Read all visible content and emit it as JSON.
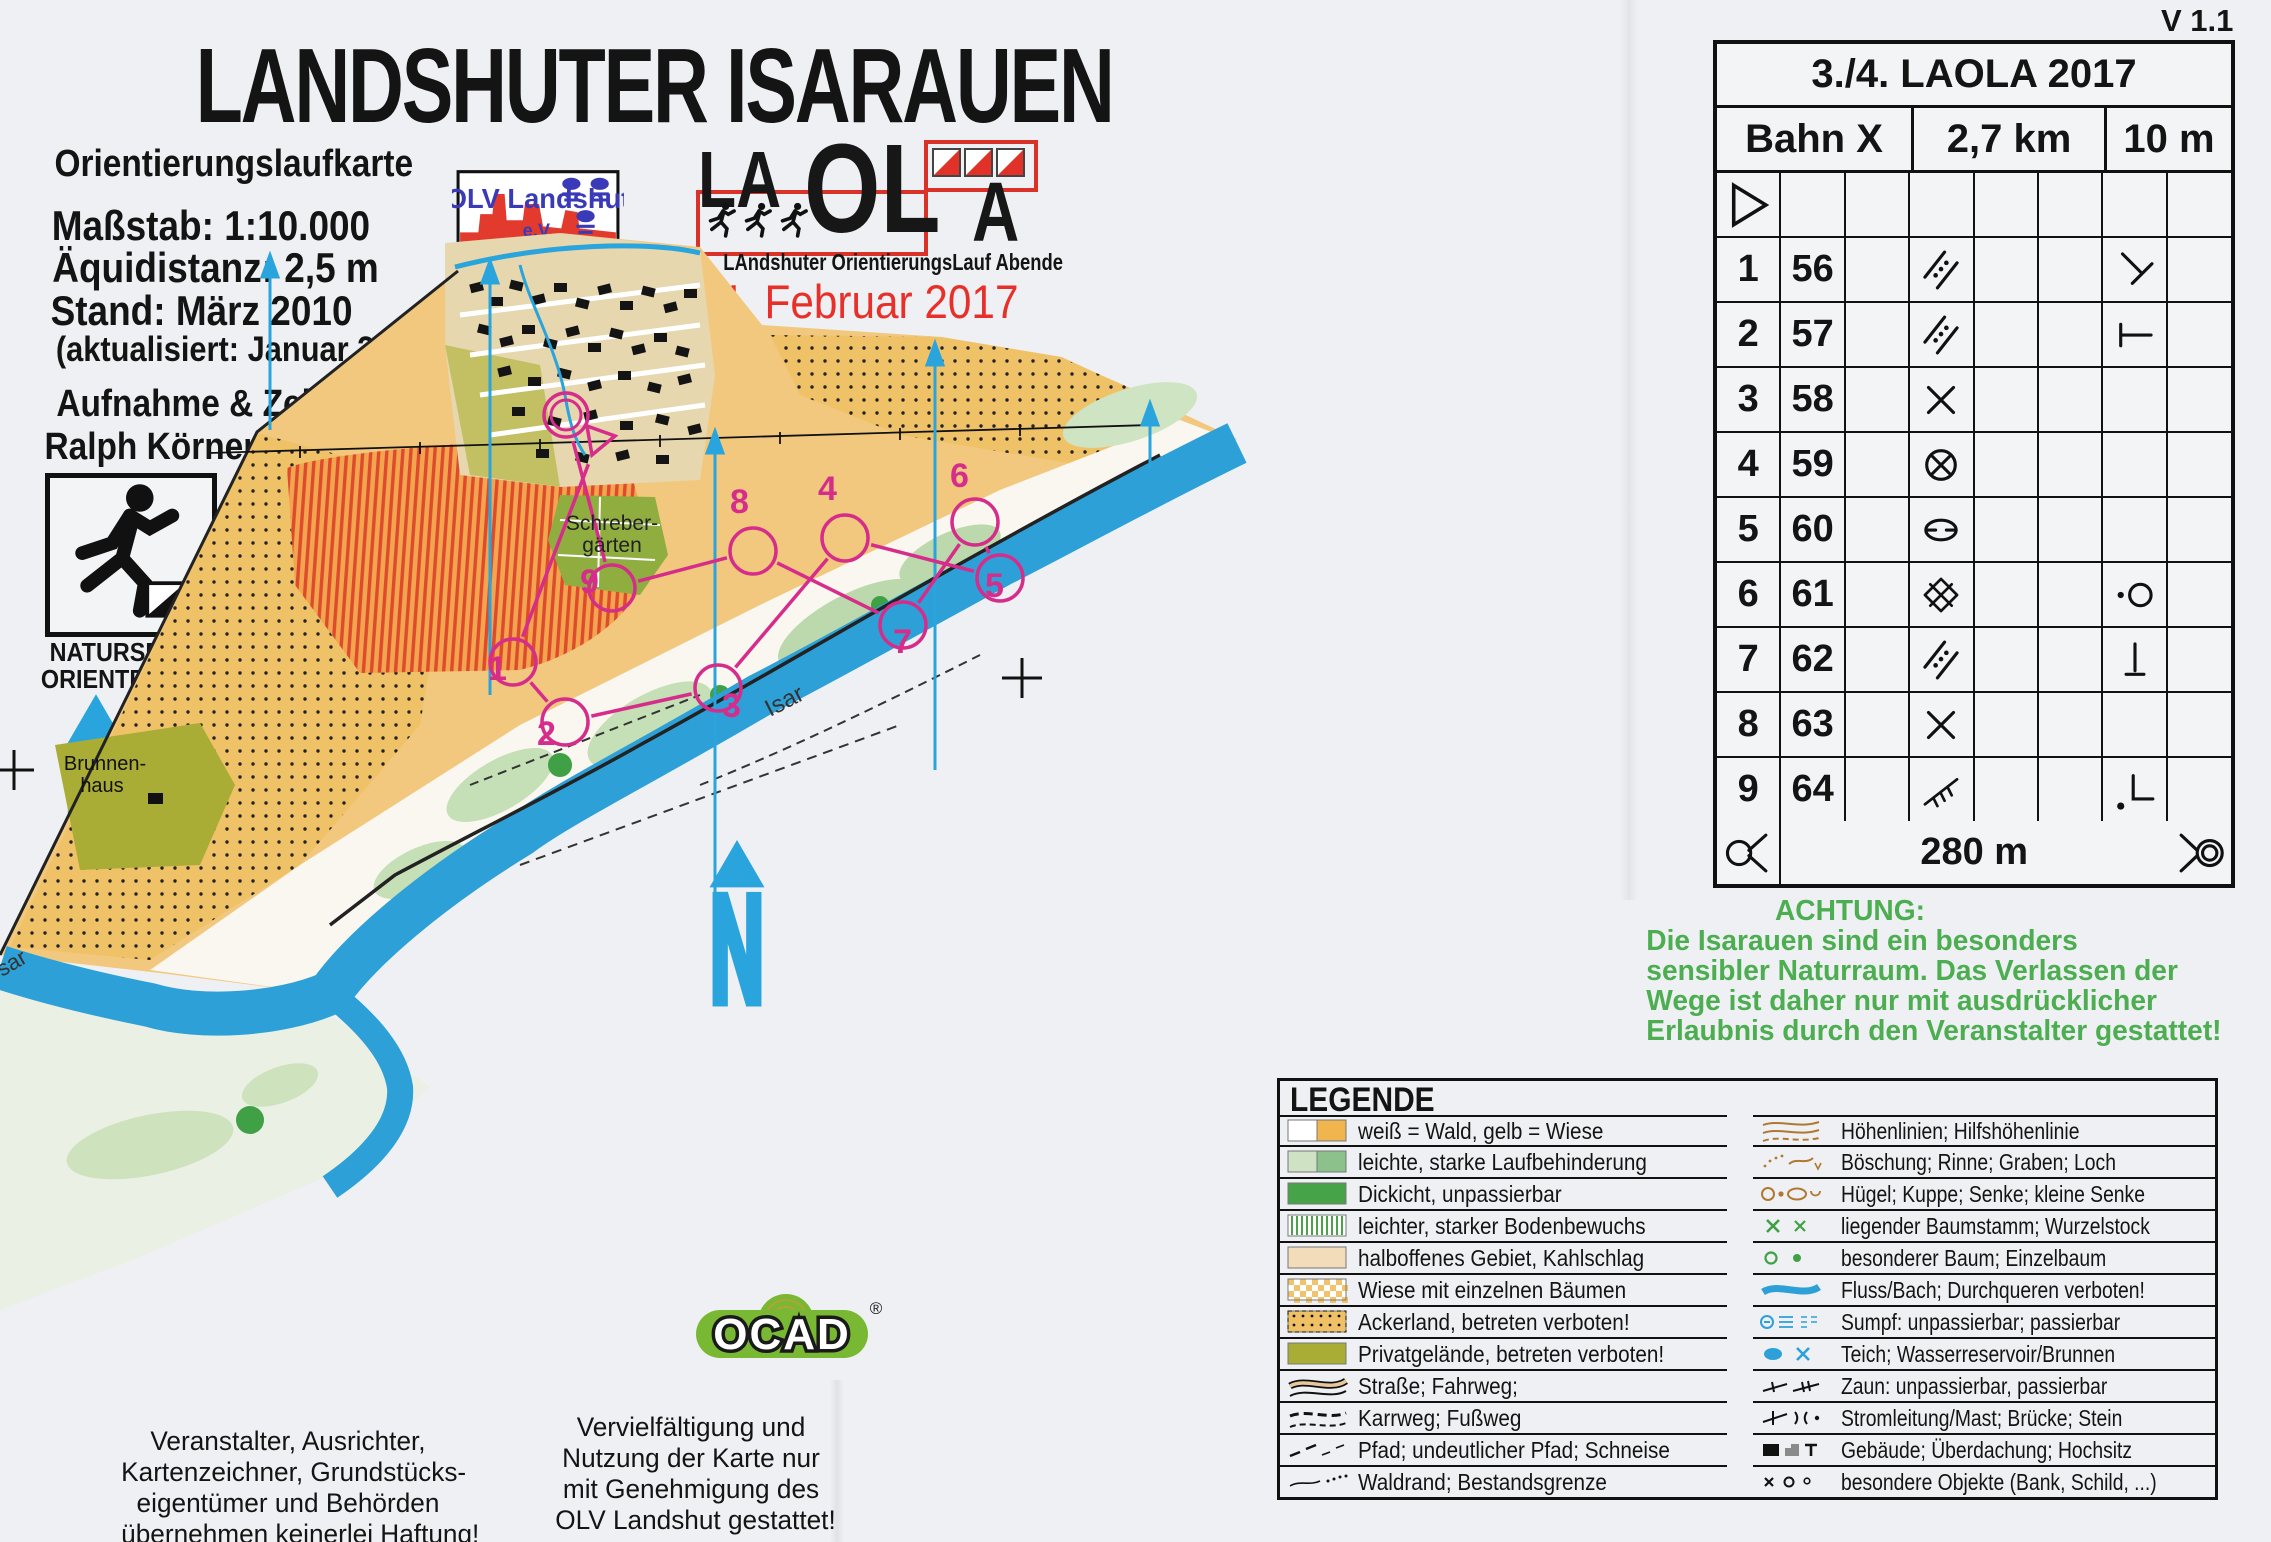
{
  "version_label": "V 1.1",
  "header": {
    "title": "LANDSHUTER ISARAUEN",
    "subtitle": "Orientierungslaufkarte",
    "scale": "Maßstab: 1:10.000",
    "equidistance": "Äquidistanz: 2,5 m",
    "edition": "Stand: März 2010",
    "updated": "(aktualisiert: Januar 2017)",
    "credit_label": "Aufnahme & Zeichnung:",
    "credit_name": "Ralph Körner"
  },
  "natursport": {
    "line1": "NATURSPORT",
    "line2": "ORIENTEERING"
  },
  "club": {
    "shield_name": "OLV Landshut",
    "shield_ev": "e.V.",
    "org_line1": "Orientierungslaufverein",
    "org_line2": "Landshut e.V.",
    "website": "www.ol-landshut.de"
  },
  "laola": {
    "part_la": "LA",
    "part_ol": "OL",
    "part_a": "A",
    "caption": "LAndshuter OrientierungsLauf Abende",
    "event_date": "4. Februar 2017"
  },
  "control_card": {
    "title": "3./4. LAOLA 2017",
    "course": "Bahn X",
    "length": "2,7 km",
    "climb": "10 m",
    "rows": [
      {
        "cells": [
          "icon:start-triangle",
          "",
          "",
          "",
          "",
          "",
          "",
          ""
        ]
      },
      {
        "cells": [
          "1",
          "56",
          "",
          "icon:veg-boundary",
          "",
          "",
          "icon:bend",
          ""
        ]
      },
      {
        "cells": [
          "2",
          "57",
          "",
          "icon:veg-boundary",
          "",
          "",
          "icon:junction",
          ""
        ]
      },
      {
        "cells": [
          "3",
          "58",
          "",
          "icon:cross",
          "",
          "",
          "",
          ""
        ]
      },
      {
        "cells": [
          "4",
          "59",
          "",
          "icon:circle-cross",
          "",
          "",
          "",
          ""
        ]
      },
      {
        "cells": [
          "5",
          "60",
          "",
          "icon:depression",
          "",
          "",
          "",
          ""
        ]
      },
      {
        "cells": [
          "6",
          "61",
          "",
          "icon:thicket",
          "",
          "",
          "icon:dot-circle",
          ""
        ]
      },
      {
        "cells": [
          "7",
          "62",
          "",
          "icon:veg-boundary",
          "",
          "",
          "icon:upright-post",
          ""
        ]
      },
      {
        "cells": [
          "8",
          "63",
          "",
          "icon:cross",
          "",
          "",
          "",
          ""
        ]
      },
      {
        "cells": [
          "9",
          "64",
          "",
          "icon:fence",
          "",
          "",
          "icon:corner-dot",
          ""
        ]
      }
    ],
    "finish": {
      "left_icon": "taped-route",
      "distance": "280 m",
      "right_icon": "finish-circles"
    }
  },
  "warning": {
    "title": "ACHTUNG:",
    "lines": [
      "Die Isarauen sind ein besonders",
      "sensibler Naturraum. Das Verlassen der",
      "Wege ist daher nur mit ausdrücklicher",
      "Erlaubnis durch den Veranstalter gestattet!"
    ]
  },
  "legend": {
    "title": "LEGENDE",
    "left": [
      {
        "icon": "forest-meadow-swatch",
        "label": "weiß = Wald, gelb = Wiese"
      },
      {
        "icon": "runnability-swatch",
        "label": "leichte, starke Laufbehinderung"
      },
      {
        "icon": "thicket-swatch",
        "label": "Dickicht, unpassierbar"
      },
      {
        "icon": "undergrowth-swatch",
        "label": "leichter, starker Bodenbewuchs"
      },
      {
        "icon": "semiopen-swatch",
        "label": "halboffenes Gebiet, Kahlschlag"
      },
      {
        "icon": "meadow-trees-swatch",
        "label": "Wiese mit einzelnen Bäumen"
      },
      {
        "icon": "farmland-swatch",
        "label": "Ackerland, betreten verboten!"
      },
      {
        "icon": "private-swatch",
        "label": "Privatgelände, betreten verboten!"
      },
      {
        "icon": "road-icon",
        "label": "Straße; Fahrweg;"
      },
      {
        "icon": "track-icon",
        "label": "Karrweg; Fußweg"
      },
      {
        "icon": "path-icon",
        "label": "Pfad; undeutlicher Pfad; Schneise"
      },
      {
        "icon": "forest-edge-icon",
        "label": "Waldrand; Bestandsgrenze"
      }
    ],
    "right": [
      {
        "icon": "contours-icon",
        "label": "Höhenlinien; Hilfshöhenlinie"
      },
      {
        "icon": "slope-icon",
        "label": "Böschung; Rinne; Graben; Loch"
      },
      {
        "icon": "knoll-icon",
        "label": "Hügel; Kuppe; Senke; kleine Senke"
      },
      {
        "icon": "log-icon",
        "label": "liegender Baumstamm; Wurzelstock"
      },
      {
        "icon": "tree-icon",
        "label": "besonderer Baum; Einzelbaum"
      },
      {
        "icon": "river-icon",
        "label": "Fluss/Bach; Durchqueren verboten!"
      },
      {
        "icon": "marsh-icon",
        "label": "Sumpf: unpassierbar; passierbar"
      },
      {
        "icon": "pond-icon",
        "label": "Teich; Wasserreservoir/Brunnen"
      },
      {
        "icon": "fence-icon",
        "label": "Zaun: unpassierbar, passierbar"
      },
      {
        "icon": "powerline-icon",
        "label": "Stromleitung/Mast; Brücke; Stein"
      },
      {
        "icon": "building-icon",
        "label": "Gebäude; Überdachung; Hochsitz"
      },
      {
        "icon": "objects-icon",
        "label": "besondere Objekte (Bank, Schild, ...)"
      }
    ]
  },
  "map_labels": {
    "allotments_line1": "Schreber-",
    "allotments_line2": "gärten",
    "river": "Isar",
    "river_partial": "sar",
    "well_line1": "Brunnen-",
    "well_line2": "haus",
    "controls": [
      "1",
      "2",
      "3",
      "4",
      "5",
      "6",
      "7",
      "8",
      "9"
    ]
  },
  "footer": {
    "liability_lines": [
      "Veranstalter, Ausrichter,",
      "Kartenzeichner, Grundstücks-",
      "eigentümer und Behörden",
      "übernehmen keinerlei Haftung!"
    ],
    "usage_lines": [
      "Vervielfältigung und",
      "Nutzung der Karte nur",
      "mit Genehmigung des",
      "OLV Landshut gestattet!"
    ]
  },
  "ocad": {
    "text": "OCAD",
    "reg": "®"
  },
  "colors": {
    "course_magenta": "#d62d8a",
    "river_blue": "#2da0d8",
    "north_blue": "#2aa4dc",
    "warning_green": "#4cae50",
    "date_red": "#e8302a"
  }
}
